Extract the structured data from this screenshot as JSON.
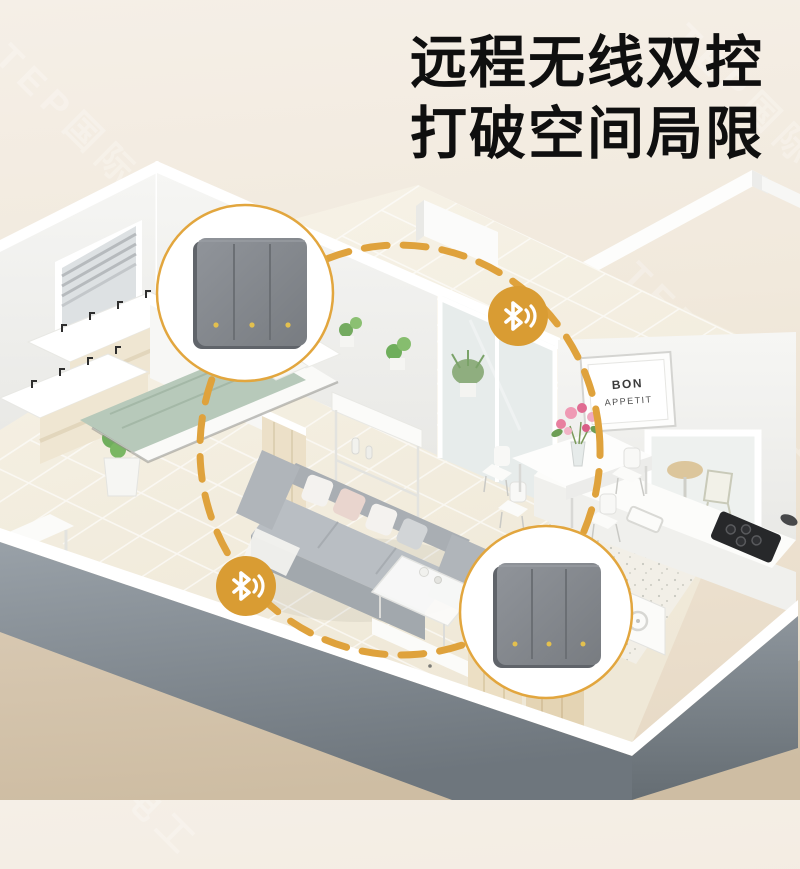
{
  "headline": {
    "line1": "远程无线双控",
    "line2": "打破空间局限"
  },
  "watermark": {
    "text": "TEP国际电工"
  },
  "wall_sign": {
    "line1": "BON",
    "line2": "APPETIT"
  },
  "switches": {
    "gang_count": 3,
    "style": "3-gang rocker wall switch",
    "panel_color": "#83878c",
    "led_color": "#e3c04e"
  },
  "connection": {
    "icon": "bluetooth-signal-icon",
    "line_style": "dashed-ellipse",
    "color": "#DFA23C"
  },
  "colors": {
    "background_top": "#f5efe7",
    "background_bottom": "#e6d8c3",
    "ground_tan": "#d6c5ae",
    "accent_gold": "#DFA23C",
    "badge_gold": "#D99C33",
    "title_black": "#0f0f0f",
    "front_wall_gray": "#8a929a",
    "sofa_gray": "#b3b8bc",
    "blanket_sage": "#b7c9ba"
  }
}
